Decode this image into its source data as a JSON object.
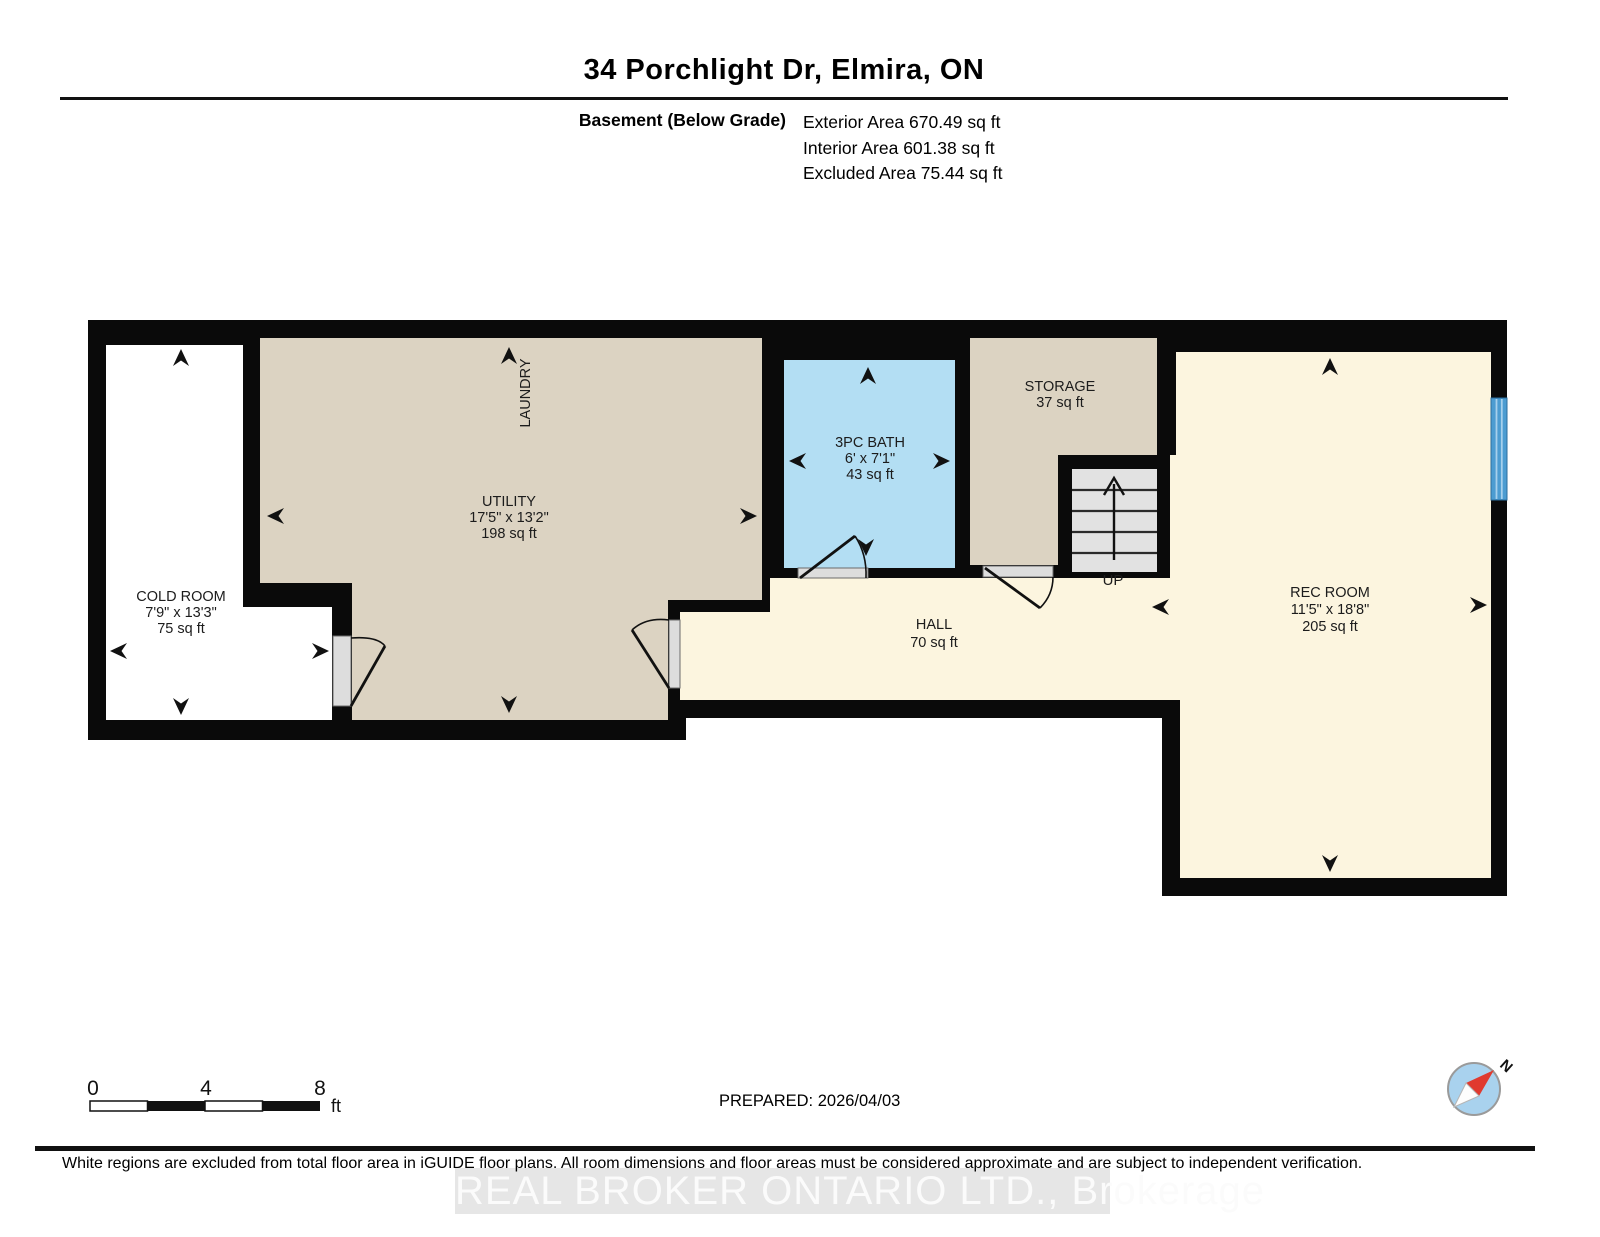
{
  "title": "34 Porchlight Dr, Elmira, ON",
  "header": {
    "floor_label": "Basement (Below Grade)",
    "exterior_area": "Exterior Area 670.49 sq ft",
    "interior_area": "Interior Area 601.38 sq ft",
    "excluded_area": "Excluded Area 75.44 sq ft"
  },
  "rooms": {
    "cold_room": {
      "name": "COLD ROOM",
      "dims": "7'9\" x 13'3\"",
      "area": "75 sq ft"
    },
    "utility": {
      "name": "UTILITY",
      "dims": "17'5\" x 13'2\"",
      "area": "198 sq ft"
    },
    "laundry": {
      "name": "LAUNDRY"
    },
    "bath": {
      "name": "3PC BATH",
      "dims": "6' x 7'1\"",
      "area": "43 sq ft"
    },
    "storage": {
      "name": "STORAGE",
      "area": "37 sq ft"
    },
    "hall": {
      "name": "HALL",
      "area": "70 sq ft"
    },
    "rec_room": {
      "name": "REC ROOM",
      "dims": "11'5\" x 18'8\"",
      "area": "205 sq ft"
    },
    "stairs": {
      "label": "UP"
    }
  },
  "scale_bar": {
    "tick0": "0",
    "tick1": "4",
    "tick2": "8",
    "unit": "ft"
  },
  "prepared_label": "PREPARED: 2026/04/03",
  "compass": {
    "north_label": "N"
  },
  "footer": {
    "disclaimer": "White regions are excluded from total floor area in iGUIDE floor plans. All room dimensions and floor areas must be considered approximate and are subject to independent verification.",
    "watermark": "REAL BROKER ONTARIO LTD., Brokerage"
  },
  "colors": {
    "wall": "#0a0a0a",
    "room_tan": "#DCD3C2",
    "room_cream": "#FCF5DF",
    "room_bath_blue": "#B3DEF3",
    "room_white": "#FFFFFF",
    "stair_gray": "#E2E2E2",
    "door_jamb_gray": "#DDDDDD",
    "window_blue": "#4C9CD1",
    "compass_blue": "#A9D2EE",
    "compass_red": "#E03A2F",
    "watermark_gray": "#E6E6E6"
  }
}
